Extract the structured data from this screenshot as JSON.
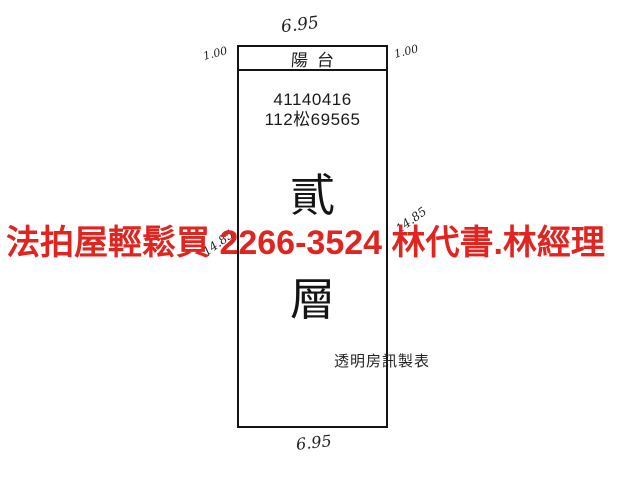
{
  "plan": {
    "balcony_label": "陽台",
    "case_number_line1": "41140416",
    "case_number_line2": "112松69565",
    "floor_label_char1": "貳",
    "floor_label_char2": "層",
    "maker_label": "透明房訊製表"
  },
  "dimensions": {
    "top_width": "6.95",
    "bottom_width": "6.95",
    "left_balcony_depth": "1.00",
    "right_balcony_depth": "1.00",
    "left_side_length": "14.85",
    "right_side_length": "14.85"
  },
  "overlay": {
    "ad_text": "法拍屋輕鬆買 2266-3524 林代書.林經理",
    "color": "#e02420"
  }
}
